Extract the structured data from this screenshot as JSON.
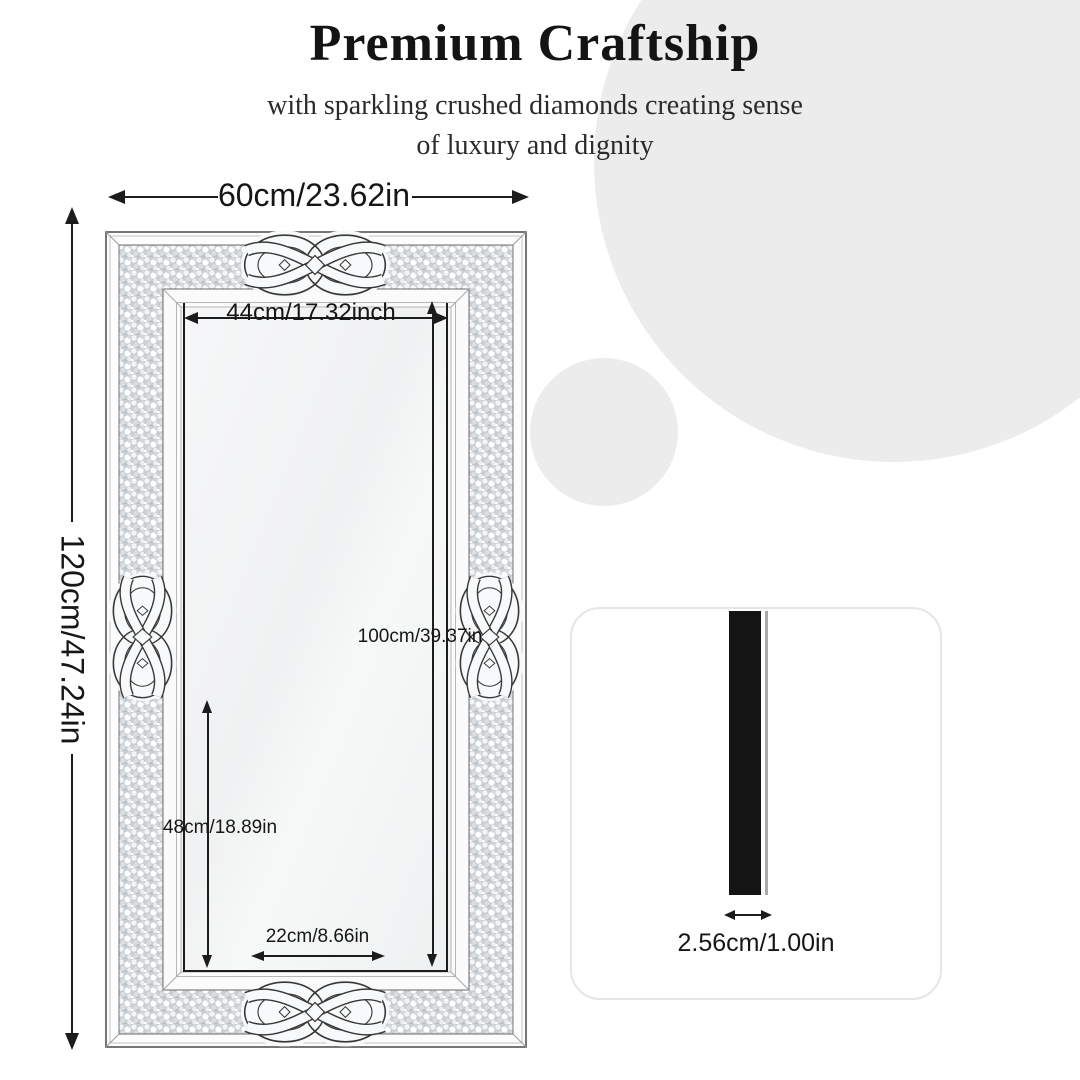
{
  "header": {
    "title": "Premium Craftship",
    "subtitle_line1": "with sparkling crushed diamonds creating sense",
    "subtitle_line2": "of luxury and dignity"
  },
  "front": {
    "outer_width": "60cm/23.62in",
    "outer_height": "120cm/47.24in",
    "inner_width": "44cm/17.32inch",
    "inner_height": "100cm/39.37in",
    "lower_height": "48cm/18.89in",
    "bottom_width": "22cm/8.66in"
  },
  "side": {
    "thickness": "2.56cm/1.00in"
  },
  "icons": {
    "dimension_arrowheads": "solid-triangle-arrowhead",
    "knot_decoration": "celtic-knot-mirror-ornament"
  },
  "colors": {
    "ink": "#1c1c1c",
    "background_circle": "#ececec",
    "crushed_diamond_base": "#c9ced2",
    "mirror_surface": "#f3f4f5",
    "side_bar_black": "#141414",
    "card_border": "#e5e5e5"
  }
}
